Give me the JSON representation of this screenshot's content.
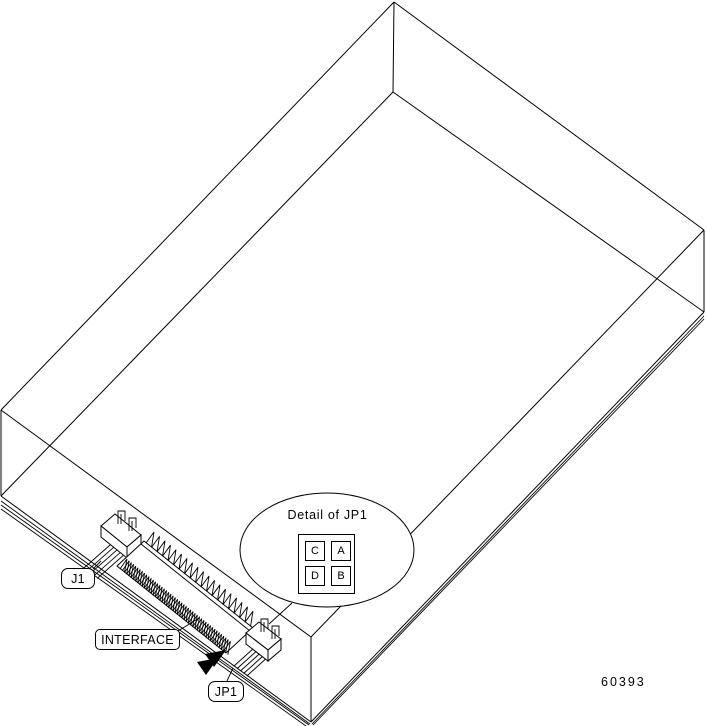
{
  "figure": {
    "figure_number": "60393",
    "labels": {
      "j1": "J1",
      "interface": "INTERFACE",
      "jp1": "JP1"
    },
    "detail": {
      "title": "Detail of JP1",
      "jumper_labels": [
        "C",
        "A",
        "D",
        "B"
      ]
    },
    "icons": {
      "pin1_arrow": "filled-double-arrowhead"
    },
    "colors": {
      "line": "#000000",
      "background": "#ffffff"
    }
  }
}
